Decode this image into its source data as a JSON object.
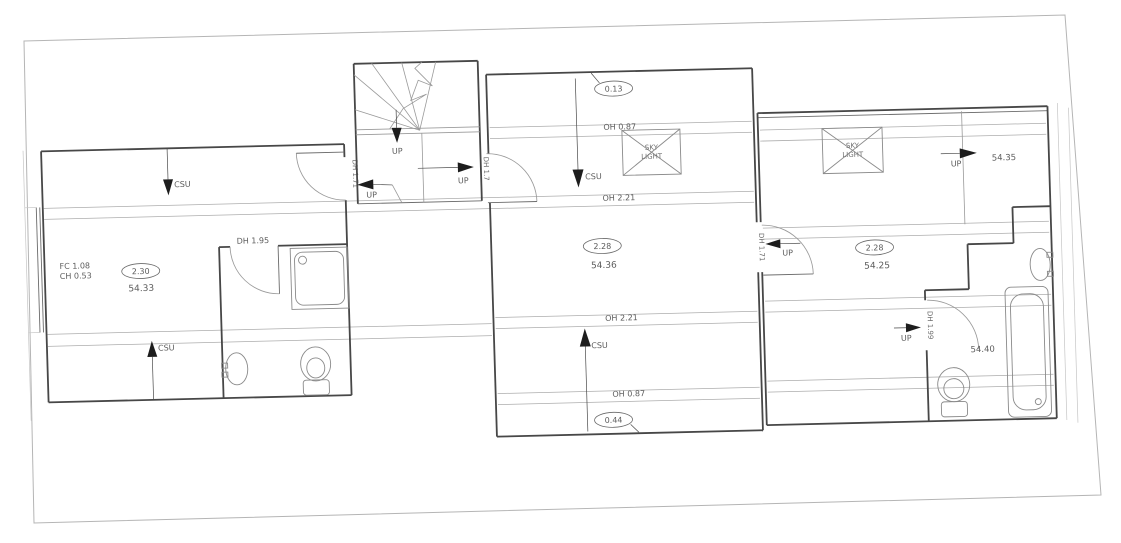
{
  "document": {
    "type": "architectural floor plan scan",
    "background": "#ffffff",
    "border_color": "#b5b5b5",
    "wall_color": "#474747",
    "text_color": "#5c5c5c"
  },
  "left_room": {
    "csu_top": "CSU",
    "csu_bottom": "CSU",
    "fc_value": "FC 1.08",
    "ch_value": "CH 0.53",
    "circled_value": "2.30",
    "area_value": "54.33",
    "door_height_right": "DH 1.71"
  },
  "left_bathroom": {
    "door_height": "DH 1.95"
  },
  "stairs": {
    "up_top": "UP",
    "up_right": "UP",
    "up_left": "UP",
    "door_height_right": "DH 1.7"
  },
  "middle_room": {
    "circled_top": "0.13",
    "oh_top": "OH 0.87",
    "skylight_line1": "SKY",
    "skylight_line2": "LIGHT",
    "csu_top": "CSU",
    "oh_upper": "OH 2.21",
    "circled_value": "2.28",
    "area_value": "54.36",
    "oh_lower": "OH 2.21",
    "csu_bottom": "CSU",
    "oh_bottom": "OH 0.87",
    "circled_bottom": "0.44",
    "door_height_right": "DH 1.71",
    "up_right_door": "UP"
  },
  "right_room": {
    "skylight_line1": "SKY",
    "skylight_line2": "LIGHT",
    "up_top": "UP",
    "level_value": "54.35",
    "circled_value": "2.28",
    "area_value": "54.25"
  },
  "right_bathroom": {
    "up_door": "UP",
    "door_height": "DH 1.99",
    "area_value": "54.40"
  }
}
